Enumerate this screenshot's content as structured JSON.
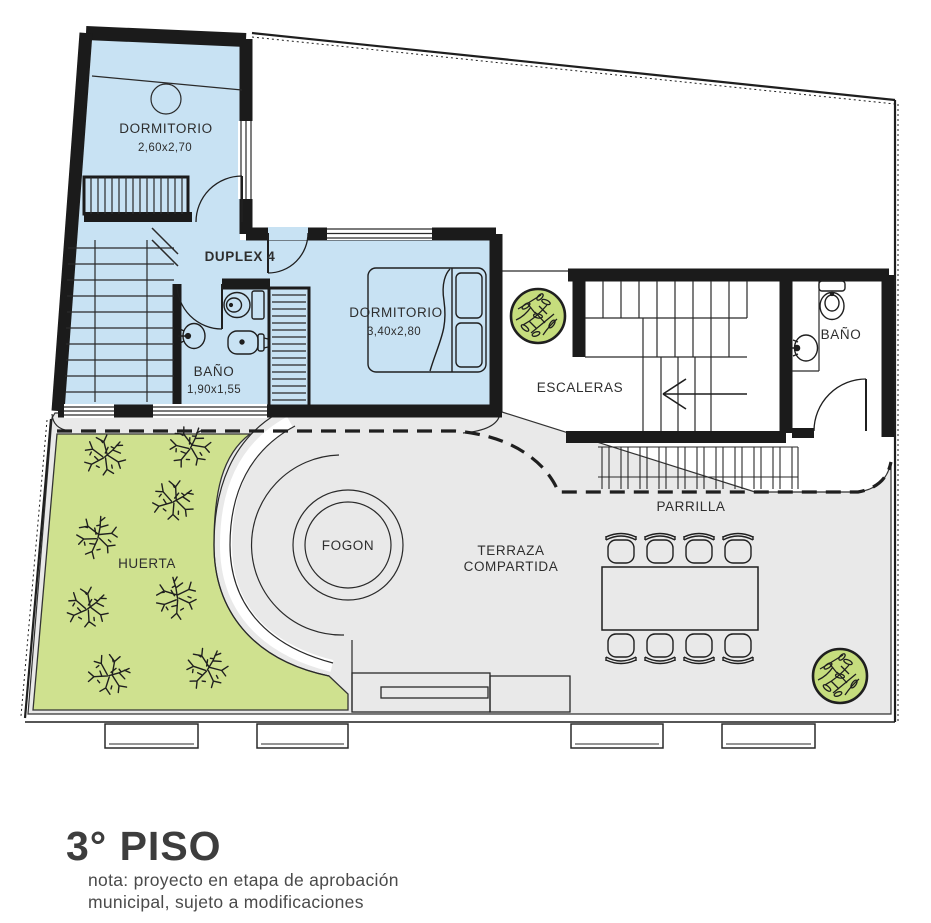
{
  "colors": {
    "unit_fill": "#c8e2f3",
    "garden_fill": "#cfe18f",
    "terrace_fill": "#e9e9e9",
    "bush_fill": "#c6dd7d",
    "wall": "#1b1b1b",
    "title": "#3d3d3d",
    "note": "#4a4a4a"
  },
  "unit": {
    "name": "DUPLEX 4"
  },
  "rooms": {
    "dormitorio1": {
      "label": "DORMITORIO",
      "dims": "2,60x2,70"
    },
    "dormitorio2": {
      "label": "DORMITORIO",
      "dims": "3,40x2,80"
    },
    "bano_duplex": {
      "label": "BAÑO",
      "dims": "1,90x1,55"
    },
    "escaleras": {
      "label": "ESCALERAS"
    },
    "bano_shared": {
      "label": "BAÑO"
    },
    "parrilla": {
      "label": "PARRILLA"
    },
    "terraza": {
      "line1": "TERRAZA",
      "line2": "COMPARTIDA"
    },
    "huerta": {
      "label": "HUERTA"
    },
    "fogon": {
      "label": "FOGON"
    }
  },
  "footer": {
    "title": "3° PISO",
    "note_line1": "nota: proyecto en etapa de aprobación",
    "note_line2": "municipal, sujeto a modificaciones"
  }
}
